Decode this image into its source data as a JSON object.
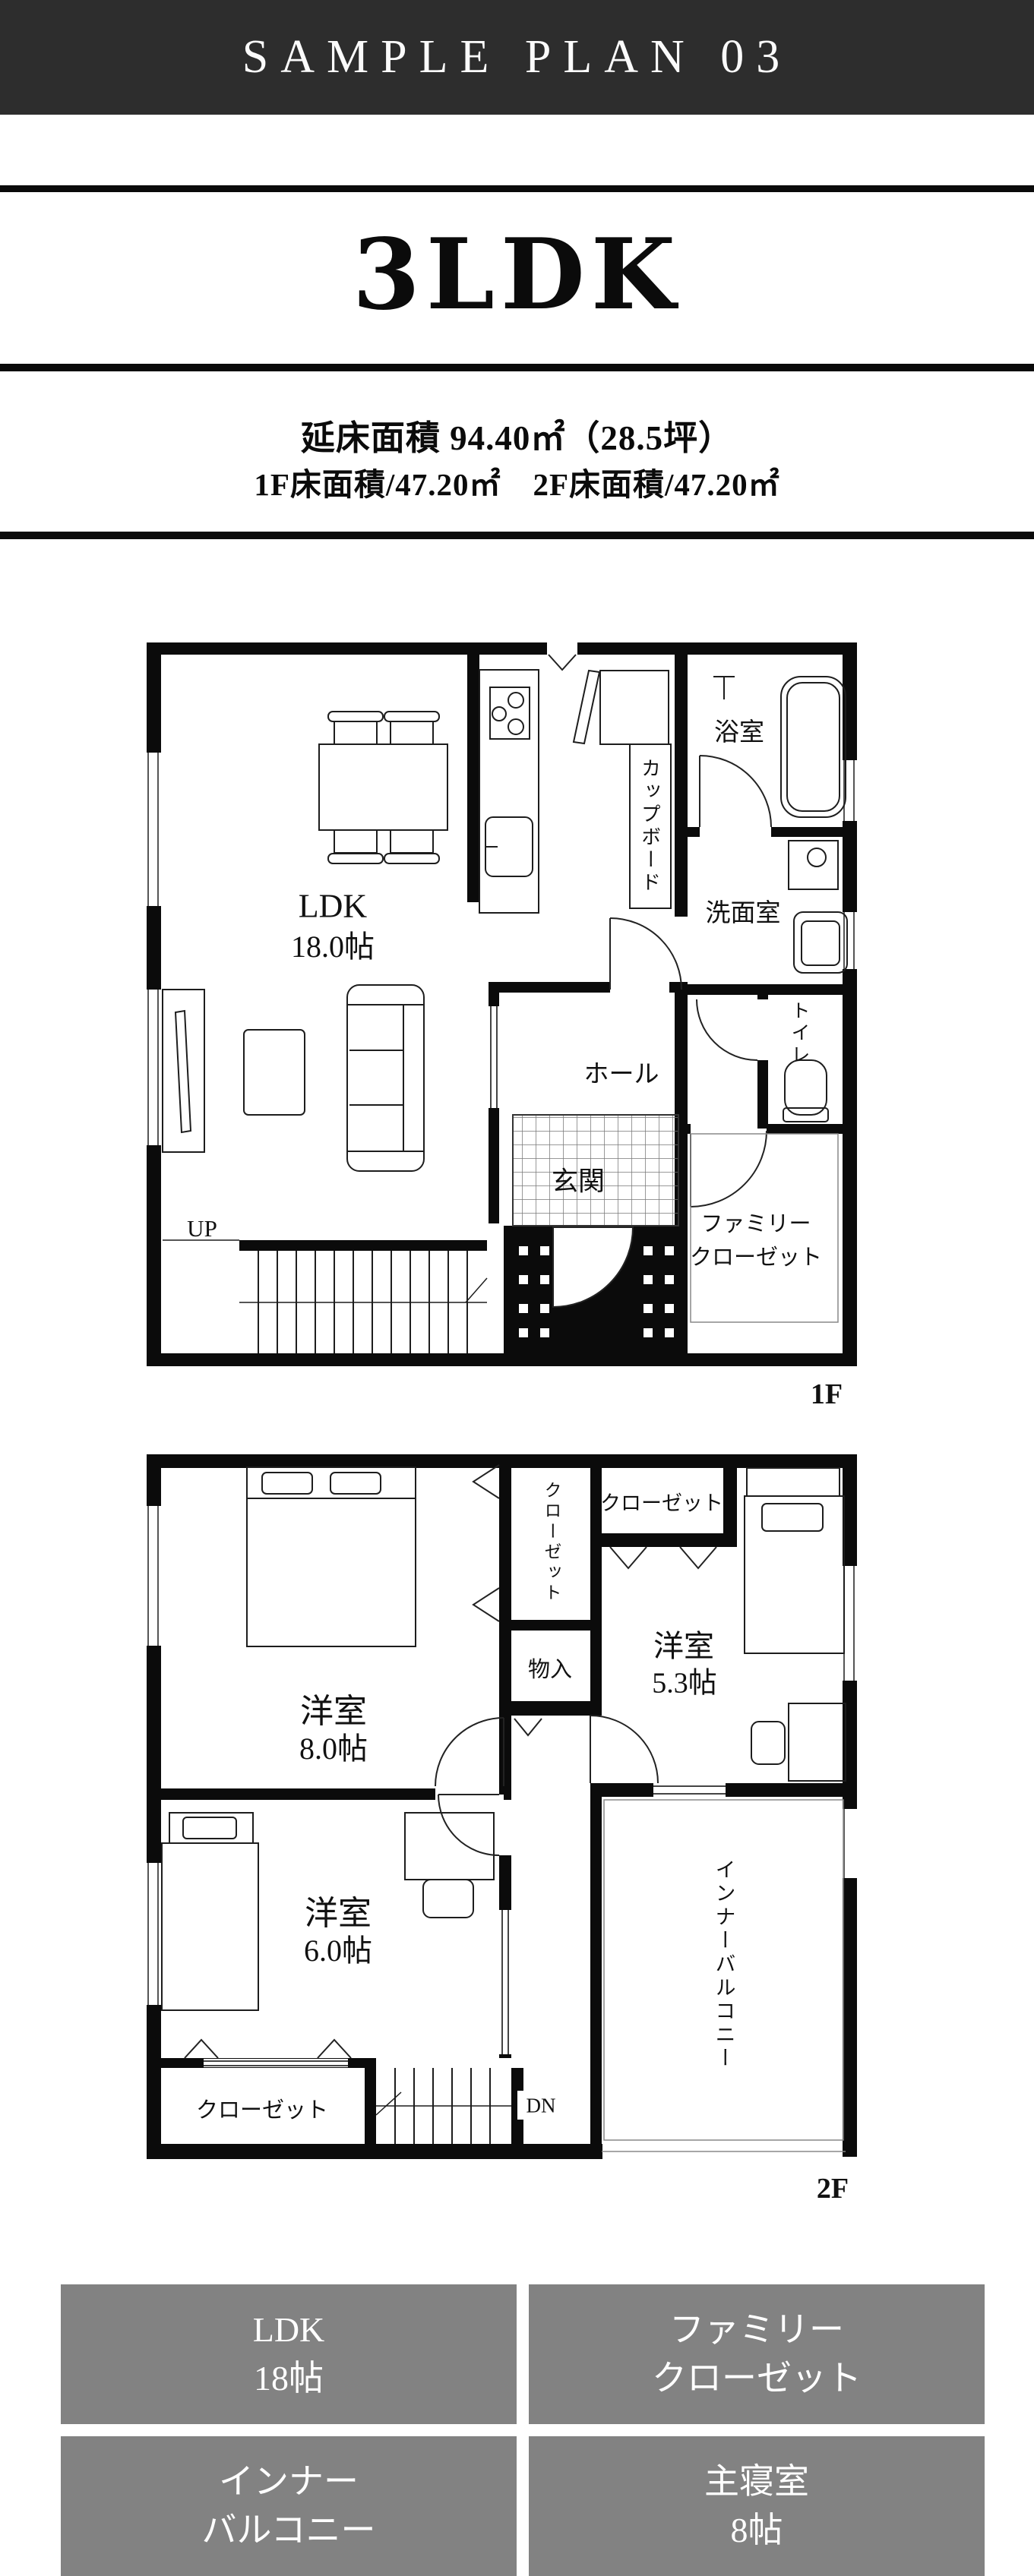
{
  "header": {
    "title": "SAMPLE PLAN 03"
  },
  "plan_title": "3LDK",
  "area": {
    "line1": "延床面積 94.40㎡（28.5坪）",
    "line2": "1F床面積/47.20㎡　2F床面積/47.20㎡"
  },
  "floor1": {
    "label": "1F",
    "ldk": "LDK",
    "ldk_size": "18.0帖",
    "cupboard": "カップボード",
    "bath": "浴室",
    "washroom": "洗面室",
    "hall": "ホール",
    "entrance": "玄関",
    "toilet": "トイレ",
    "family_closet_line1": "ファミリー",
    "family_closet_line2": "クローゼット",
    "up": "UP"
  },
  "floor2": {
    "label": "2F",
    "bedroom8": "洋室",
    "bedroom8_size": "8.0帖",
    "closet_a": "クローゼット",
    "closet_b": "クローゼット",
    "storage": "物入",
    "bedroom53": "洋室",
    "bedroom53_size": "5.3帖",
    "bedroom6": "洋室",
    "bedroom6_size": "6.0帖",
    "inner_balcony": "インナーバルコニー",
    "closet_c": "クローゼット",
    "dn": "DN"
  },
  "legend": {
    "items": [
      {
        "line1": "LDK",
        "line2": "18帖"
      },
      {
        "line1": "ファミリー",
        "line2": "クローゼット"
      },
      {
        "line1": "インナー",
        "line2": "バルコニー"
      },
      {
        "line1": "主寝室",
        "line2": "8帖"
      }
    ]
  },
  "colors": {
    "header_bg": "#2d2d2d",
    "legend_bg": "#828282",
    "wall": "#0b0b0b"
  }
}
